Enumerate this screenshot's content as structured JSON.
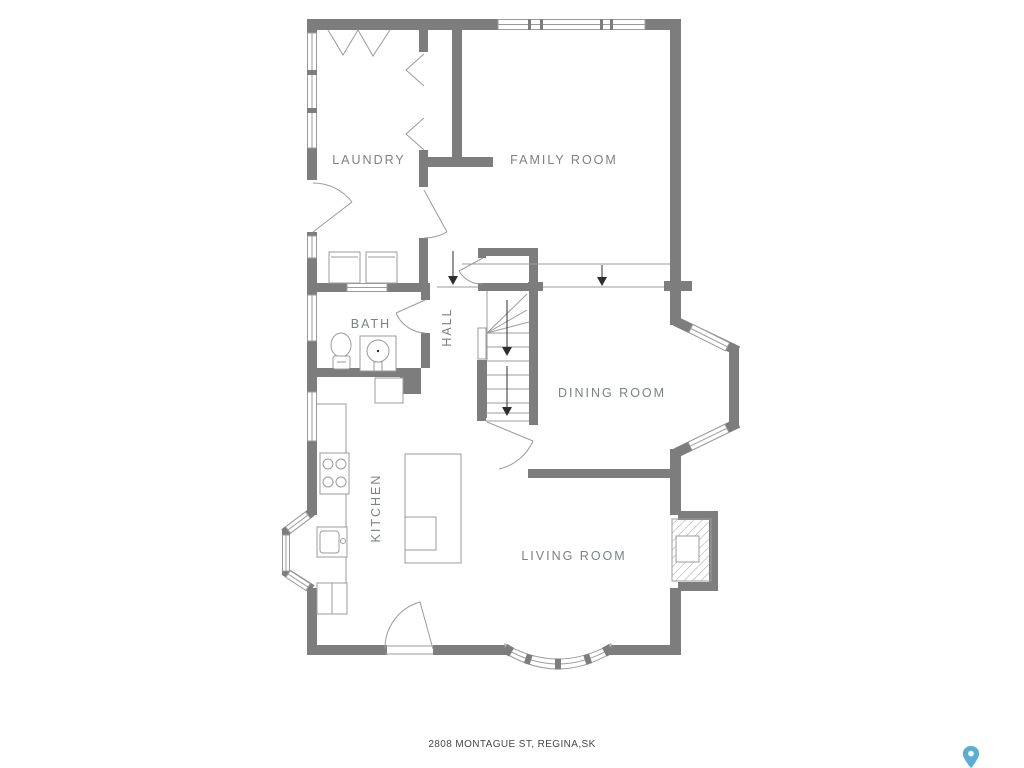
{
  "floorplan": {
    "rooms": {
      "laundry": {
        "label": "LAUNDRY"
      },
      "family_room": {
        "label": "FAMILY ROOM"
      },
      "bath": {
        "label": "BATH"
      },
      "hall": {
        "label": "HALL"
      },
      "dining_room": {
        "label": "DINING ROOM"
      },
      "kitchen": {
        "label": "KITCHEN"
      },
      "living_room": {
        "label": "LIVING ROOM"
      }
    },
    "address": "2808 MONTAGUE ST, REGINA,SK",
    "icons": {
      "map_pin": {
        "name": "map-pin-icon",
        "color": "#5aaed6"
      }
    },
    "colors": {
      "background": "#ffffff",
      "wall": "#7d7d7d",
      "thin_line": "#9b9b9b",
      "room_label": "#7b8184",
      "address_text": "#474747",
      "arrow": "#2e2e2e"
    }
  }
}
